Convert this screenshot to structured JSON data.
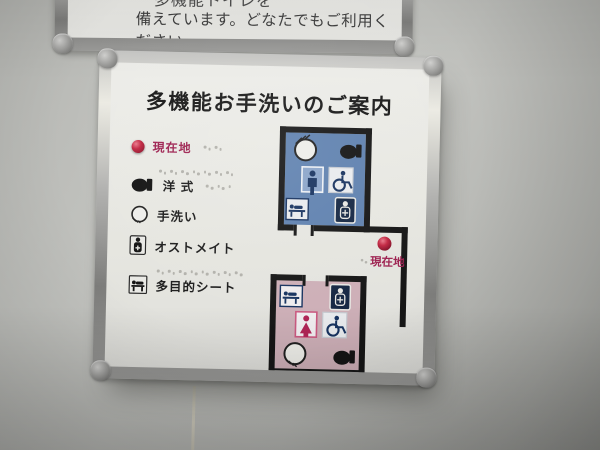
{
  "top_sign": {
    "partial_line": "多機能トイレを",
    "line": "備えています。どなたでもご利用ください。"
  },
  "sign": {
    "title": "多機能お手洗いのご案内",
    "legend": {
      "items": [
        {
          "icon": "current-location-dot",
          "label": "現在地",
          "color": "#9d2150"
        },
        {
          "icon": "western-toilet",
          "label": "洋 式"
        },
        {
          "icon": "hand-wash-basin",
          "label": "手洗い"
        },
        {
          "icon": "ostomate",
          "label": "オストメイト"
        },
        {
          "icon": "multipurpose-sheet",
          "label": "多目的シート"
        }
      ]
    },
    "map": {
      "current_location_label": "現在地",
      "wall_color": "#161616",
      "rooms": [
        {
          "id": "mens-room",
          "fill": "#5f81af",
          "icons": [
            "hand-wash-basin",
            "western-toilet",
            "man",
            "wheelchair",
            "multipurpose-sheet",
            "ostomate"
          ]
        },
        {
          "id": "womens-room",
          "fill": "#cdafb7",
          "icons": [
            "multipurpose-sheet",
            "ostomate",
            "woman",
            "wheelchair",
            "hand-wash-basin",
            "western-toilet"
          ]
        }
      ]
    },
    "colors": {
      "man_pictogram": "#17325f",
      "woman_pictogram": "#b12456",
      "current_location": "#9d2150",
      "panel": "#e8e8e3"
    }
  }
}
